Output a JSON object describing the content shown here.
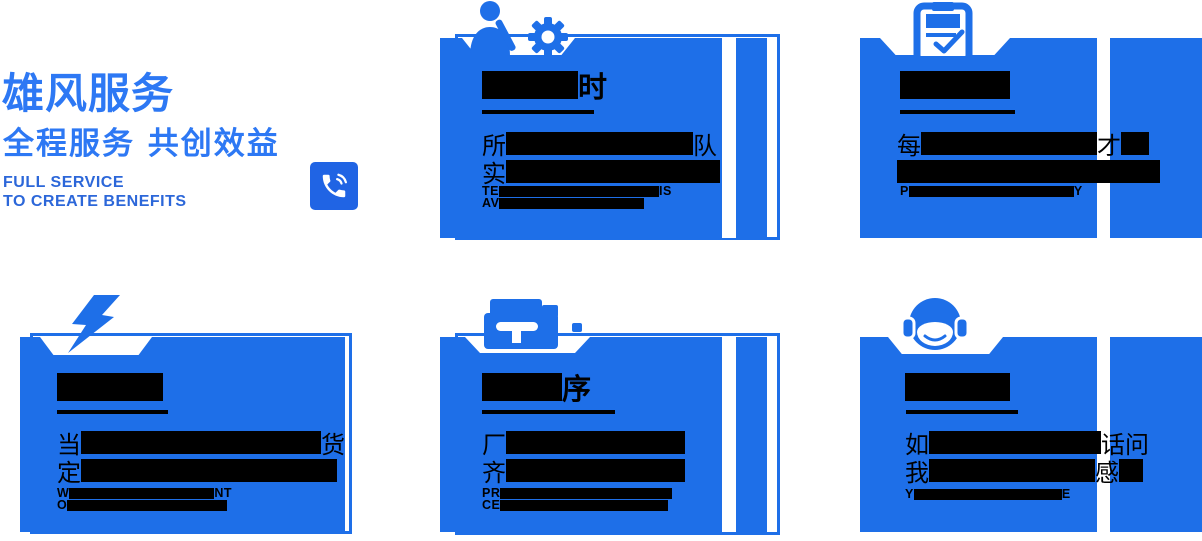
{
  "colors": {
    "primary": "#1e6fe8",
    "accent": "#2d78f4",
    "caption": "#2c67d9",
    "phone_bg": "#2064e4",
    "redaction": "#000000",
    "card_text": "#000000"
  },
  "header": {
    "title": "雄风服务",
    "subtitle": "全程服务 共创效益",
    "caption_line1": "FULL SERVICE",
    "caption_line2": "TO CREATE BENEFITS"
  },
  "phone_button": {
    "icon": "phone-icon"
  },
  "cards": [
    {
      "name": "service-card-1",
      "icon": "technician-gear-icon",
      "title": [
        {
          "b": 96,
          "h": 28
        },
        {
          "t": "时"
        }
      ],
      "body": [
        [
          {
            "t": "所"
          },
          {
            "b": 187,
            "h": 23
          },
          {
            "t": "队"
          }
        ],
        [
          {
            "t": "实"
          },
          {
            "b": 214,
            "h": 23
          }
        ]
      ],
      "en": [
        [
          {
            "t": "TE"
          },
          {
            "b": 160,
            "h": 11
          },
          {
            "t": "IS"
          }
        ],
        [
          {
            "t": "AV"
          },
          {
            "b": 145,
            "h": 11
          }
        ]
      ]
    },
    {
      "name": "service-card-2",
      "icon": "clipboard-check-icon",
      "title": [
        {
          "b": 110,
          "h": 28
        }
      ],
      "body": [
        [
          {
            "t": "每"
          },
          {
            "b": 176,
            "h": 23
          },
          {
            "t": "才"
          },
          {
            "b": 28,
            "h": 23
          }
        ],
        [
          {
            "b": 263,
            "h": 23
          }
        ]
      ],
      "en": [
        [
          {
            "t": "P"
          },
          {
            "b": 165,
            "h": 11
          },
          {
            "t": "Y"
          }
        ]
      ]
    },
    {
      "name": "service-card-3",
      "icon": "lightning-icon",
      "title": [
        {
          "b": 106,
          "h": 28
        }
      ],
      "body": [
        [
          {
            "t": "当"
          },
          {
            "b": 240,
            "h": 23
          },
          {
            "t": "货"
          }
        ],
        [
          {
            "t": "定"
          },
          {
            "b": 256,
            "h": 23
          }
        ]
      ],
      "en": [
        [
          {
            "t": "W"
          },
          {
            "b": 145,
            "h": 11
          },
          {
            "t": "NT"
          }
        ],
        [
          {
            "t": "O"
          },
          {
            "b": 160,
            "h": 11
          }
        ]
      ]
    },
    {
      "name": "service-card-4",
      "icon": "storefront-icon",
      "title": [
        {
          "b": 80,
          "h": 28
        },
        {
          "t": "序"
        }
      ],
      "body": [
        [
          {
            "t": "厂"
          },
          {
            "b": 179,
            "h": 23
          }
        ],
        [
          {
            "t": "齐"
          },
          {
            "b": 179,
            "h": 23
          }
        ]
      ],
      "en": [
        [
          {
            "t": "PR"
          },
          {
            "b": 172,
            "h": 11
          }
        ],
        [
          {
            "t": "CE"
          },
          {
            "b": 168,
            "h": 11
          }
        ]
      ]
    },
    {
      "name": "service-card-5",
      "icon": "customer-service-icon",
      "title": [
        {
          "b": 105,
          "h": 28
        }
      ],
      "body": [
        [
          {
            "t": "如"
          },
          {
            "b": 172,
            "h": 23
          },
          {
            "t": "话问"
          }
        ],
        [
          {
            "t": "我"
          },
          {
            "b": 166,
            "h": 23
          },
          {
            "t": "感"
          },
          {
            "b": 24,
            "h": 23
          }
        ]
      ],
      "en": [
        [
          {
            "t": "Y"
          },
          {
            "b": 148,
            "h": 11
          },
          {
            "t": "E"
          }
        ]
      ]
    }
  ]
}
